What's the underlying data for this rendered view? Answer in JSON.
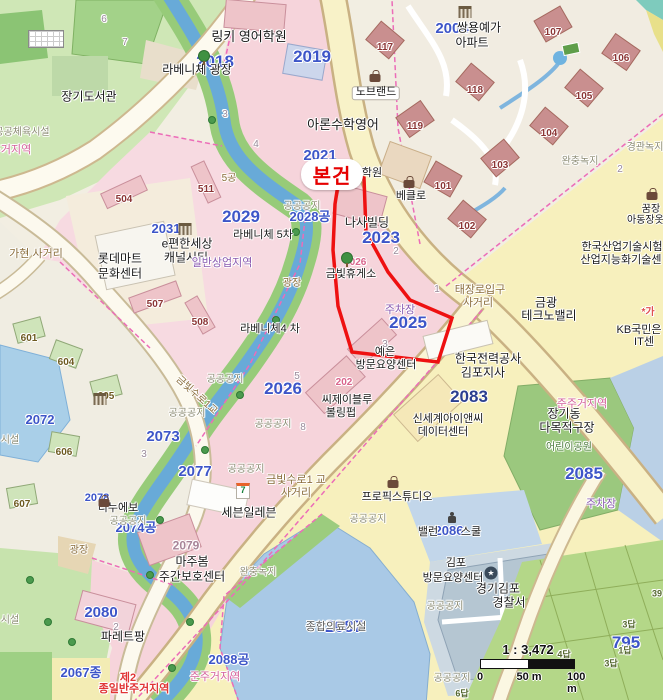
{
  "map": {
    "subject_marker": {
      "label": "본건",
      "color": "#e60000"
    },
    "scale": {
      "ratio_label": "1 : 3,472",
      "tick_0": "0",
      "tick_50": "50 m",
      "tick_100": "100 m"
    },
    "palette": {
      "water": "#68aad8",
      "park_green": "#9bc87e",
      "residential_pink": "#f6d4db",
      "commercial_yellow": "#f7f0bd",
      "road_yellow": "#f8f2c8",
      "subject_red": "#ee1111",
      "parcel_blue_text": "#3d55c8",
      "zone_boundary_magenta": "#ec6cb8"
    },
    "labels": [
      {
        "n": "parcel-2018",
        "t": "2018",
        "x": 215,
        "y": 62,
        "c": "nb lg"
      },
      {
        "n": "parcel-2019",
        "t": "2019",
        "x": 312,
        "y": 57,
        "c": "nb lg"
      },
      {
        "n": "parcel-2021",
        "t": "2021",
        "x": 320,
        "y": 156,
        "c": "nb"
      },
      {
        "n": "parcel-2023",
        "t": "2023",
        "x": 381,
        "y": 238,
        "c": "nb lg"
      },
      {
        "n": "parcel-2025",
        "t": "2025",
        "x": 408,
        "y": 323,
        "c": "nb lg"
      },
      {
        "n": "parcel-2026",
        "t": "2026",
        "x": 283,
        "y": 389,
        "c": "nb lg"
      },
      {
        "n": "parcel-2028",
        "t": "2028공",
        "x": 310,
        "y": 217,
        "c": "nb sm"
      },
      {
        "n": "parcel-2029",
        "t": "2029",
        "x": 241,
        "y": 217,
        "c": "nb lg"
      },
      {
        "n": "parcel-2031",
        "t": "2031",
        "x": 166,
        "y": 229,
        "c": "nb sm"
      },
      {
        "n": "parcel-2004",
        "t": "2004",
        "x": 452,
        "y": 29,
        "c": "nb"
      },
      {
        "n": "parcel-2072",
        "t": "2072",
        "x": 40,
        "y": 420,
        "c": "nb sm"
      },
      {
        "n": "parcel-2073",
        "t": "2073",
        "x": 163,
        "y": 437,
        "c": "nb"
      },
      {
        "n": "parcel-2074",
        "t": "2074공",
        "x": 136,
        "y": 528,
        "c": "nb sm"
      },
      {
        "n": "parcel-2077",
        "t": "2077",
        "x": 195,
        "y": 472,
        "c": "nb"
      },
      {
        "n": "parcel-2078",
        "t": "2078",
        "x": 97,
        "y": 499,
        "c": "nb xs"
      },
      {
        "n": "parcel-2080",
        "t": "2080",
        "x": 101,
        "y": 613,
        "c": "nb"
      },
      {
        "n": "parcel-2083",
        "t": "2083",
        "x": 469,
        "y": 397,
        "c": "nb lg dk"
      },
      {
        "n": "parcel-2085",
        "t": "2085",
        "x": 584,
        "y": 474,
        "c": "nb lg"
      },
      {
        "n": "parcel-2086",
        "t": "2086",
        "x": 449,
        "y": 531,
        "c": "nb sm"
      },
      {
        "n": "parcel-2087",
        "t": "2087",
        "x": 344,
        "y": 627,
        "c": "nb lg"
      },
      {
        "n": "parcel-2088",
        "t": "2088공",
        "x": 229,
        "y": 660,
        "c": "nb sm"
      },
      {
        "n": "parcel-2067",
        "t": "2067종",
        "x": 81,
        "y": 673,
        "c": "nb sm"
      },
      {
        "n": "parcel-795",
        "t": "795",
        "x": 626,
        "y": 643,
        "c": "nb lg"
      },
      {
        "n": "bldg-117",
        "t": "117",
        "x": 385,
        "y": 48,
        "c": "br"
      },
      {
        "n": "bldg-119",
        "t": "119",
        "x": 415,
        "y": 127,
        "c": "br"
      },
      {
        "n": "bldg-107",
        "t": "107",
        "x": 553,
        "y": 33,
        "c": "br"
      },
      {
        "n": "bldg-106",
        "t": "106",
        "x": 621,
        "y": 59,
        "c": "br"
      },
      {
        "n": "bldg-105",
        "t": "105",
        "x": 584,
        "y": 97,
        "c": "br"
      },
      {
        "n": "bldg-104",
        "t": "104",
        "x": 549,
        "y": 134,
        "c": "br"
      },
      {
        "n": "bldg-118",
        "t": "118",
        "x": 475,
        "y": 91,
        "c": "br"
      },
      {
        "n": "bldg-101",
        "t": "101",
        "x": 443,
        "y": 187,
        "c": "br"
      },
      {
        "n": "bldg-102",
        "t": "102",
        "x": 467,
        "y": 227,
        "c": "br"
      },
      {
        "n": "bldg-103",
        "t": "103",
        "x": 500,
        "y": 166,
        "c": "br"
      },
      {
        "n": "bldg-504",
        "t": "504",
        "x": 124,
        "y": 200,
        "c": "br"
      },
      {
        "n": "bldg-511",
        "t": "511",
        "x": 206,
        "y": 190,
        "c": "br"
      },
      {
        "n": "bldg-507",
        "t": "507",
        "x": 155,
        "y": 305,
        "c": "br"
      },
      {
        "n": "bldg-508",
        "t": "508",
        "x": 200,
        "y": 323,
        "c": "br"
      },
      {
        "n": "bldg-601",
        "t": "601",
        "x": 29,
        "y": 339,
        "c": "bgn"
      },
      {
        "n": "bldg-604",
        "t": "604",
        "x": 66,
        "y": 363,
        "c": "bgn"
      },
      {
        "n": "bldg-605",
        "t": "605",
        "x": 106,
        "y": 397,
        "c": "bgn"
      },
      {
        "n": "bldg-606",
        "t": "606",
        "x": 64,
        "y": 453,
        "c": "bgn"
      },
      {
        "n": "bldg-607",
        "t": "607",
        "x": 22,
        "y": 505,
        "c": "bgn"
      },
      {
        "n": "poi-linky-academy",
        "t": "링키 영어학원",
        "x": 249,
        "y": 37,
        "c": "poi p13"
      },
      {
        "n": "poi-nobrand",
        "t": "노브랜드",
        "x": 376,
        "y": 93,
        "c": "poi box"
      },
      {
        "n": "poi-aron-math",
        "t": "아론수학영어",
        "x": 343,
        "y": 125,
        "c": "poi p13"
      },
      {
        "n": "poi-janggi-library",
        "t": "장기도서관",
        "x": 89,
        "y": 97,
        "c": "poi p12"
      },
      {
        "n": "poi-laveniche-plaza",
        "t": "라베니체 광장",
        "x": 197,
        "y": 70,
        "c": "poi p12"
      },
      {
        "n": "poi-ssangyong-yega",
        "t": "쌍용예가",
        "x": 479,
        "y": 28,
        "c": "poi p12"
      },
      {
        "n": "poi-ssangyong-yega2",
        "t": "아파트",
        "x": 472,
        "y": 43,
        "c": "poi p12"
      },
      {
        "n": "poi-epyeonhan",
        "t": "e편한세상",
        "x": 187,
        "y": 244,
        "c": "poi p12"
      },
      {
        "n": "poi-canalcity",
        "t": "캐널시티",
        "x": 186,
        "y": 258,
        "c": "poi p12"
      },
      {
        "n": "poi-lottemart",
        "t": "롯데마트",
        "x": 120,
        "y": 259,
        "c": "poi p12"
      },
      {
        "n": "poi-culture-center",
        "t": "문화센터",
        "x": 120,
        "y": 274,
        "c": "poi p12"
      },
      {
        "n": "poi-laveniche5",
        "t": "라베니체 5차",
        "x": 263,
        "y": 236,
        "c": "poi"
      },
      {
        "n": "poi-laveniche4",
        "t": "라베니체4 차",
        "x": 270,
        "y": 330,
        "c": "poi"
      },
      {
        "n": "poi-nasa-bldg",
        "t": "나사빌딩",
        "x": 367,
        "y": 223,
        "c": "poi p12"
      },
      {
        "n": "poi-hagwon",
        "t": "학원",
        "x": 372,
        "y": 174,
        "c": "poi"
      },
      {
        "n": "poi-beklo",
        "t": "베클로",
        "x": 411,
        "y": 197,
        "c": "poi"
      },
      {
        "n": "poi-geumbit-rest",
        "t": "금빛휴게소",
        "x": 351,
        "y": 275,
        "c": "poi"
      },
      {
        "n": "poi-yeeun",
        "t": "예은",
        "x": 385,
        "y": 353,
        "c": "poi"
      },
      {
        "n": "poi-yeeun2",
        "t": "방문요양센터",
        "x": 386,
        "y": 366,
        "c": "poi"
      },
      {
        "n": "poi-cj-blue",
        "t": "씨제이블루",
        "x": 347,
        "y": 401,
        "c": "poi"
      },
      {
        "n": "poi-bowling",
        "t": "볼링펍",
        "x": 341,
        "y": 414,
        "c": "poi"
      },
      {
        "n": "poi-shinsegae-inc",
        "t": "신세계아이앤씨",
        "x": 448,
        "y": 420,
        "c": "poi"
      },
      {
        "n": "poi-datacenter",
        "t": "데이터센터",
        "x": 443,
        "y": 433,
        "c": "poi"
      },
      {
        "n": "poi-kepco",
        "t": "한국전력공사",
        "x": 488,
        "y": 359,
        "c": "poi p12"
      },
      {
        "n": "poi-gimpo-branch",
        "t": "김포지사",
        "x": 483,
        "y": 373,
        "c": "poi p12"
      },
      {
        "n": "poi-kitech1",
        "t": "한국산업기술시험",
        "x": 622,
        "y": 248,
        "c": "poi"
      },
      {
        "n": "poi-kitech2",
        "t": "산업지능화기술센",
        "x": 621,
        "y": 261,
        "c": "poi"
      },
      {
        "n": "poi-geumgwang",
        "t": "금광",
        "x": 546,
        "y": 303,
        "c": "poi p12"
      },
      {
        "n": "poi-technovalley",
        "t": "테크노밸리",
        "x": 549,
        "y": 316,
        "c": "poi p12"
      },
      {
        "n": "poi-kb1",
        "t": "KB국민은",
        "x": 639,
        "y": 331,
        "c": "poi"
      },
      {
        "n": "poi-kb2",
        "t": "IT센",
        "x": 644,
        "y": 343,
        "c": "poi"
      },
      {
        "n": "poi-kkum1",
        "t": "꿈장",
        "x": 651,
        "y": 210,
        "c": "poi rds"
      },
      {
        "n": "poi-kkum2",
        "t": "아동장옷점",
        "x": 650,
        "y": 221,
        "c": "poi rds"
      },
      {
        "n": "poi-propix",
        "t": "프로픽스튜디오",
        "x": 397,
        "y": 498,
        "c": "poi"
      },
      {
        "n": "poi-seveneleven",
        "t": "세븐일레븐",
        "x": 249,
        "y": 513,
        "c": "poi p12"
      },
      {
        "n": "poi-dinuevo",
        "t": "디누에보",
        "x": 118,
        "y": 509,
        "c": "poi"
      },
      {
        "n": "poi-majubom",
        "t": "마주봄",
        "x": 192,
        "y": 562,
        "c": "poi p12"
      },
      {
        "n": "poi-daycare",
        "t": "주간보호센터",
        "x": 192,
        "y": 577,
        "c": "poi p12"
      },
      {
        "n": "poi-palettepang",
        "t": "파레트팡",
        "x": 123,
        "y": 637,
        "c": "poi p12"
      },
      {
        "n": "poi-gimpo-care1",
        "t": "김포",
        "x": 456,
        "y": 564,
        "c": "poi"
      },
      {
        "n": "poi-gimpo-care2",
        "t": "방문요양센터",
        "x": 453,
        "y": 579,
        "c": "poi"
      },
      {
        "n": "poi-ballan",
        "t": "밸런",
        "x": 428,
        "y": 533,
        "c": "poi"
      },
      {
        "n": "poi-school",
        "t": "스쿨",
        "x": 471,
        "y": 533,
        "c": "poi"
      },
      {
        "n": "poi-police1",
        "t": "경기김포",
        "x": 498,
        "y": 589,
        "c": "poi p12"
      },
      {
        "n": "poi-police2",
        "t": "경찰서",
        "x": 509,
        "y": 603,
        "c": "poi p12"
      },
      {
        "n": "poi-janggidong",
        "t": "장기동",
        "x": 564,
        "y": 414,
        "c": "poi p12"
      },
      {
        "n": "poi-multipurpose",
        "t": "다목적구장",
        "x": 567,
        "y": 428,
        "c": "poi p12"
      },
      {
        "n": "poi-children-park",
        "t": "어린이공원",
        "x": 569,
        "y": 448,
        "c": "grn"
      },
      {
        "n": "poi-medical-site",
        "t": "종합의료시설",
        "x": 336,
        "y": 628,
        "c": "zgd"
      },
      {
        "n": "zone-gonggong-1",
        "t": "공공공지",
        "x": 302,
        "y": 207,
        "c": "zg"
      },
      {
        "n": "zone-gonggong-2",
        "t": "공공공지",
        "x": 225,
        "y": 380,
        "c": "zg"
      },
      {
        "n": "zone-gonggong-3",
        "t": "공공공지",
        "x": 187,
        "y": 414,
        "c": "zg"
      },
      {
        "n": "zone-gonggong-4",
        "t": "공공공지",
        "x": 273,
        "y": 425,
        "c": "zg"
      },
      {
        "n": "zone-gonggong-5",
        "t": "공공공지",
        "x": 246,
        "y": 470,
        "c": "zg"
      },
      {
        "n": "zone-gonggong-6",
        "t": "공공공지",
        "x": 128,
        "y": 522,
        "c": "zg"
      },
      {
        "n": "zone-gonggong-7",
        "t": "공공공지",
        "x": 368,
        "y": 520,
        "c": "zg"
      },
      {
        "n": "zone-gonggong-8",
        "t": "공공공지",
        "x": 445,
        "y": 607,
        "c": "zg"
      },
      {
        "n": "zone-gonggong-9",
        "t": "공공공지",
        "x": 452,
        "y": 679,
        "c": "zg"
      },
      {
        "n": "zone-buffer-1",
        "t": "완충녹지",
        "x": 580,
        "y": 162,
        "c": "zg"
      },
      {
        "n": "zone-buffer-2",
        "t": "완충녹지",
        "x": 258,
        "y": 573,
        "c": "zg"
      },
      {
        "n": "zone-landscape",
        "t": "경관녹지",
        "x": 645,
        "y": 148,
        "c": "zg"
      },
      {
        "n": "zone-sports",
        "t": "공공체육시설",
        "x": 22,
        "y": 133,
        "c": "zg"
      },
      {
        "n": "zone-junju-tl",
        "t": "준주거지역",
        "x": 6,
        "y": 151,
        "c": "zp"
      },
      {
        "n": "zone-siseol-1",
        "t": "시설",
        "x": 10,
        "y": 441,
        "c": "zg"
      },
      {
        "n": "zone-siseol-2",
        "t": "시설",
        "x": 10,
        "y": 621,
        "c": "zg"
      },
      {
        "n": "zone-commercial",
        "t": "일반상업지역",
        "x": 222,
        "y": 264,
        "c": "zpu"
      },
      {
        "n": "zone-junju-1",
        "t": "준주거지역",
        "x": 582,
        "y": 405,
        "c": "zp"
      },
      {
        "n": "zone-junju-2",
        "t": "준주거지역",
        "x": 215,
        "y": 678,
        "c": "zp"
      },
      {
        "n": "zone-res2-1",
        "t": "제2",
        "x": 128,
        "y": 679,
        "c": "zr"
      },
      {
        "n": "zone-res2-2",
        "t": "종일반주거지역",
        "x": 134,
        "y": 690,
        "c": "zr"
      },
      {
        "n": "zone-parking-1",
        "t": "주차장",
        "x": 400,
        "y": 311,
        "c": "zpu"
      },
      {
        "n": "zone-parking-2",
        "t": "주차장",
        "x": 601,
        "y": 505,
        "c": "zpu"
      },
      {
        "n": "road-gahyeon",
        "t": "가현 사거리",
        "x": 36,
        "y": 255,
        "c": "rd"
      },
      {
        "n": "road-taejang1",
        "t": "태장로입구",
        "x": 480,
        "y": 291,
        "c": "rd"
      },
      {
        "n": "road-taejang2",
        "t": "사거리",
        "x": 478,
        "y": 304,
        "c": "rd"
      },
      {
        "n": "road-geumbit1",
        "t": "금빛수로1 교",
        "x": 296,
        "y": 481,
        "c": "rd"
      },
      {
        "n": "road-geumbit2",
        "t": "사거리",
        "x": 296,
        "y": 494,
        "c": "rd"
      },
      {
        "n": "road-geumbit-bridge",
        "t": "금빛수로1교",
        "x": 196,
        "y": 396,
        "c": "rds rd",
        "r": 42
      },
      {
        "n": "road-plaza-1",
        "t": "광장",
        "x": 292,
        "y": 284,
        "c": "rds rd"
      },
      {
        "n": "road-plaza-2",
        "t": "광장",
        "x": 79,
        "y": 551,
        "c": "rds rd"
      },
      {
        "n": "road-5gong",
        "t": "5공",
        "x": 229,
        "y": 179,
        "c": "rds rd"
      },
      {
        "n": "num-2079",
        "t": "2079",
        "x": 186,
        "y": 546,
        "c": "gp"
      },
      {
        "n": "num-202",
        "t": "202",
        "x": 344,
        "y": 383,
        "c": "pk"
      },
      {
        "n": "num-026",
        "t": "026",
        "x": 358,
        "y": 263,
        "c": "pk"
      },
      {
        "n": "mark-red",
        "t": "*가",
        "x": 648,
        "y": 313,
        "c": "rm"
      },
      {
        "n": "field-3dap-1",
        "t": "3답",
        "x": 629,
        "y": 625,
        "c": "fd"
      },
      {
        "n": "field-1dap",
        "t": "1답",
        "x": 625,
        "y": 651,
        "c": "fd"
      },
      {
        "n": "field-3dap-2",
        "t": "3답",
        "x": 611,
        "y": 664,
        "c": "fd"
      },
      {
        "n": "field-4dap",
        "t": "4답",
        "x": 564,
        "y": 655,
        "c": "fd"
      },
      {
        "n": "field-6dap",
        "t": "6답",
        "x": 462,
        "y": 694,
        "c": "fd"
      },
      {
        "n": "field-39",
        "t": "39",
        "x": 657,
        "y": 594,
        "c": "fd"
      },
      {
        "n": "lot-6",
        "t": "6",
        "x": 104,
        "y": 20,
        "c": "gn"
      },
      {
        "n": "lot-7",
        "t": "7",
        "x": 125,
        "y": 43,
        "c": "gn"
      },
      {
        "n": "lot-3a",
        "t": "3",
        "x": 225,
        "y": 115,
        "c": "gn"
      },
      {
        "n": "lot-4a",
        "t": "4",
        "x": 256,
        "y": 145,
        "c": "gn"
      },
      {
        "n": "lot-2a",
        "t": "2",
        "x": 396,
        "y": 252,
        "c": "gn"
      },
      {
        "n": "lot-3b",
        "t": "3",
        "x": 385,
        "y": 345,
        "c": "gn"
      },
      {
        "n": "lot-5",
        "t": "5",
        "x": 297,
        "y": 377,
        "c": "gn"
      },
      {
        "n": "lot-8",
        "t": "8",
        "x": 303,
        "y": 428,
        "c": "gn"
      },
      {
        "n": "lot-3c",
        "t": "3",
        "x": 144,
        "y": 455,
        "c": "gn"
      },
      {
        "n": "lot-1",
        "t": "1",
        "x": 437,
        "y": 290,
        "c": "gn"
      },
      {
        "n": "lot-2b",
        "t": "2",
        "x": 620,
        "y": 170,
        "c": "gn"
      },
      {
        "n": "lot-2c",
        "t": "2",
        "x": 116,
        "y": 628,
        "c": "gn"
      }
    ],
    "icons": [
      {
        "n": "shop-bag-icon",
        "x": 375,
        "y": 78,
        "c": "i-bag"
      },
      {
        "n": "shop-bag-icon",
        "x": 409,
        "y": 184,
        "c": "i-bag"
      },
      {
        "n": "shop-bag-icon",
        "x": 104,
        "y": 503,
        "c": "i-bag"
      },
      {
        "n": "shop-bag-icon",
        "x": 393,
        "y": 484,
        "c": "i-bag"
      },
      {
        "n": "shop-bag-icon",
        "x": 652,
        "y": 196,
        "c": "i-bag"
      },
      {
        "n": "tree-icon",
        "x": 204,
        "y": 56,
        "c": "i-tree"
      },
      {
        "n": "tree-icon",
        "x": 347,
        "y": 258,
        "c": "i-tree"
      },
      {
        "n": "public-building-icon",
        "x": 465,
        "y": 12,
        "c": "i-bank"
      },
      {
        "n": "public-building-icon",
        "x": 185,
        "y": 229,
        "c": "i-bank"
      },
      {
        "n": "public-building-icon",
        "x": 100,
        "y": 399,
        "c": "i-bank"
      },
      {
        "n": "seven-eleven-icon",
        "x": 243,
        "y": 491,
        "c": "i-7",
        "t": "7"
      },
      {
        "n": "police-icon",
        "x": 491,
        "y": 573,
        "c": "i-police",
        "t": "★"
      },
      {
        "n": "child-icon",
        "x": 452,
        "y": 518,
        "c": "i-person"
      },
      {
        "n": "library-building-icon",
        "x": 46,
        "y": 39,
        "c": "i-grid"
      }
    ]
  }
}
